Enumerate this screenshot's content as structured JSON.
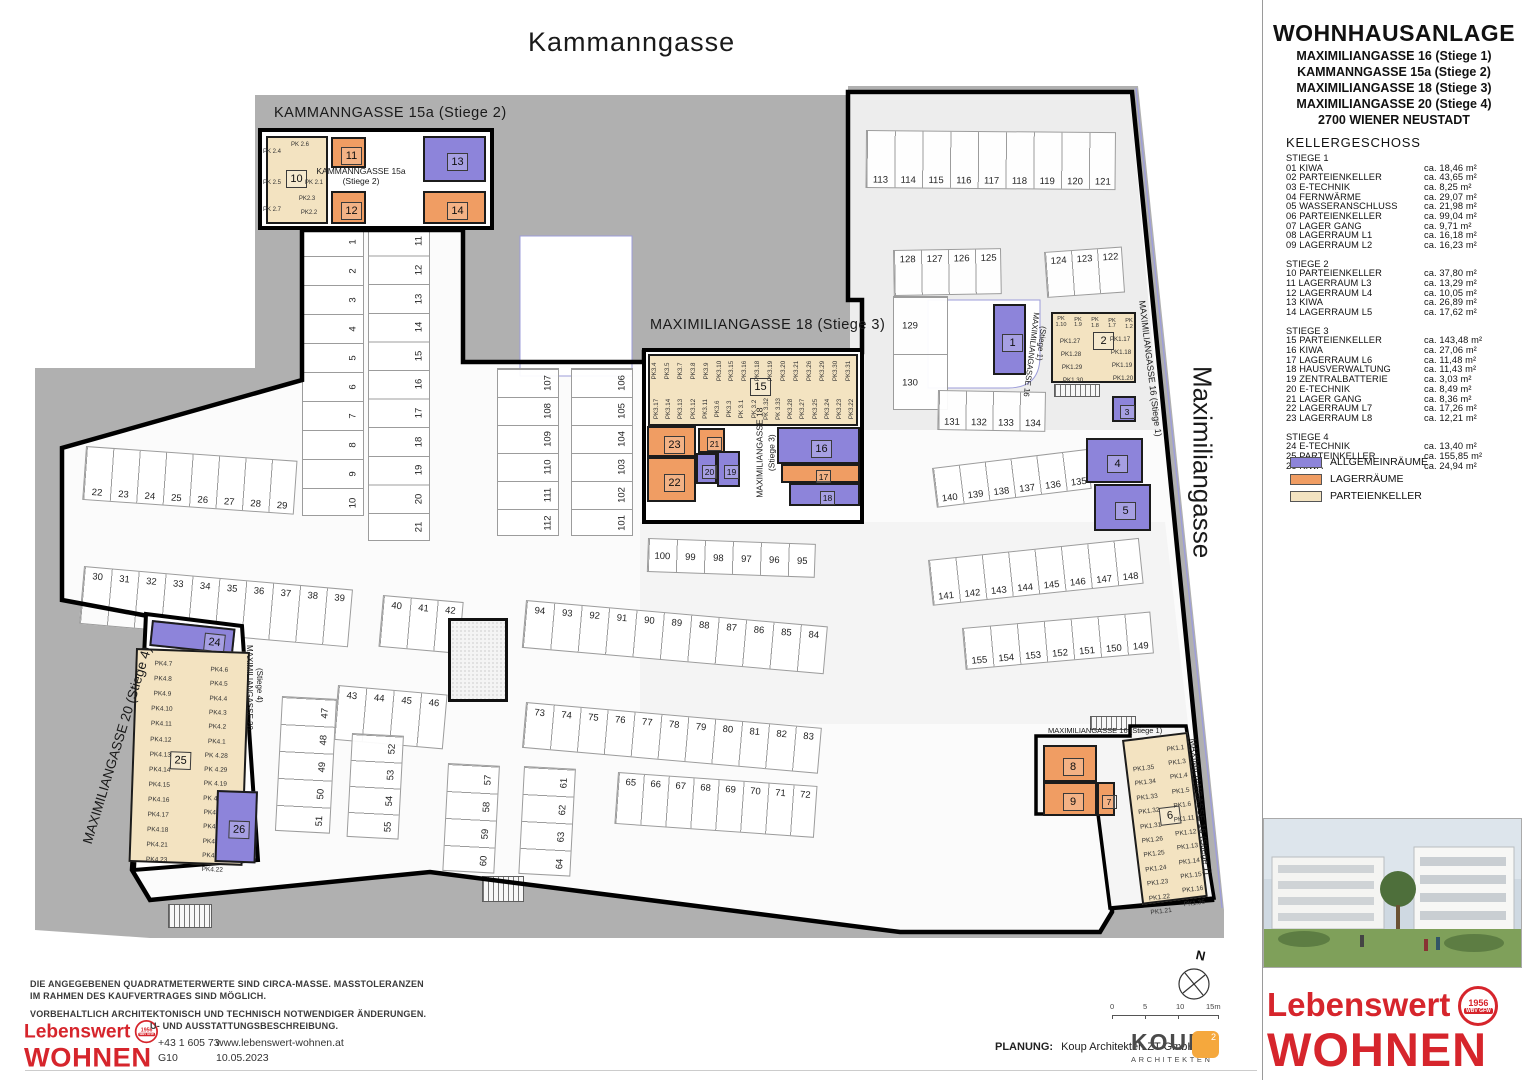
{
  "title_block": {
    "project": "WOHNHAUSANLAGE",
    "addresses": [
      "MAXIMILIANGASSE 16 (Stiege 1)",
      "KAMMANNGASSE 15a (Stiege 2)",
      "MAXIMILIANGASSE 18 (Stiege 3)",
      "MAXIMILIANGASSE 20 (Stiege 4)"
    ],
    "city": "2700 WIENER NEUSTADT",
    "floor": "KELLERGESCHOSS"
  },
  "schedule": [
    {
      "name": "STIEGE 1",
      "rooms": [
        {
          "nr": "01",
          "label": "KIWA",
          "area": "ca. 18,46 m²"
        },
        {
          "nr": "02",
          "label": "PARTEIENKELLER",
          "area": "ca. 43,65 m²"
        },
        {
          "nr": "03",
          "label": "E-TECHNIK",
          "area": "ca. 8,25 m²"
        },
        {
          "nr": "04",
          "label": "FERNWÄRME",
          "area": "ca. 29,07 m²"
        },
        {
          "nr": "05",
          "label": "WASSERANSCHLUSS",
          "area": "ca. 21,98 m²"
        },
        {
          "nr": "06",
          "label": "PARTEIENKELLER",
          "area": "ca. 99,04 m²"
        },
        {
          "nr": "07",
          "label": "LAGER GANG",
          "area": "ca. 9,71 m²"
        },
        {
          "nr": "08",
          "label": "LAGERRAUM L1",
          "area": "ca. 16,18 m²"
        },
        {
          "nr": "09",
          "label": "LAGERRAUM L2",
          "area": "ca. 16,23 m²"
        }
      ]
    },
    {
      "name": "STIEGE 2",
      "rooms": [
        {
          "nr": "10",
          "label": "PARTEIENKELLER",
          "area": "ca. 37,80 m²"
        },
        {
          "nr": "11",
          "label": "LAGERRAUM L3",
          "area": "ca. 13,29 m²"
        },
        {
          "nr": "12",
          "label": "LAGERRAUM L4",
          "area": "ca. 10,05 m²"
        },
        {
          "nr": "13",
          "label": "KIWA",
          "area": "ca. 26,89 m²"
        },
        {
          "nr": "14",
          "label": "LAGERRAUM L5",
          "area": "ca. 17,62 m²"
        }
      ]
    },
    {
      "name": "STIEGE 3",
      "rooms": [
        {
          "nr": "15",
          "label": "PARTEIENKELLER",
          "area": "ca. 143,48 m²"
        },
        {
          "nr": "16",
          "label": "KIWA",
          "area": "ca. 27,06 m²"
        },
        {
          "nr": "17",
          "label": "LAGERRAUM L6",
          "area": "ca. 11,48 m²"
        },
        {
          "nr": "18",
          "label": "HAUSVERWALTUNG",
          "area": "ca. 11,43 m²"
        },
        {
          "nr": "19",
          "label": "ZENTRALBATTERIE",
          "area": "ca. 3,03 m²"
        },
        {
          "nr": "20",
          "label": "E-TECHNIK",
          "area": "ca. 8,49 m²"
        },
        {
          "nr": "21",
          "label": "LAGER GANG",
          "area": "ca. 8,36 m²"
        },
        {
          "nr": "22",
          "label": "LAGERRAUM L7",
          "area": "ca. 17,26 m²"
        },
        {
          "nr": "23",
          "label": "LAGERRAUM L8",
          "area": "ca. 12,21 m²"
        }
      ]
    },
    {
      "name": "STIEGE 4",
      "rooms": [
        {
          "nr": "24",
          "label": "E-TECHNIK",
          "area": "ca. 13,40 m²"
        },
        {
          "nr": "25",
          "label": "PARTEINKELLER",
          "area": "ca. 155,85 m²"
        },
        {
          "nr": "26",
          "label": "KIWA",
          "area": "ca. 24,94 m²"
        }
      ]
    }
  ],
  "legend": [
    {
      "type": "allgemein",
      "label": "ALLGEMEINRÄUME",
      "color": "#8d84da"
    },
    {
      "type": "lager",
      "label": "LAGERRÄUME",
      "color": "#f09d63"
    },
    {
      "type": "partei",
      "label": "PARTEIENKELLER",
      "color": "#f3e3c1"
    }
  ],
  "streets": {
    "top": "Kammanngasse",
    "right": "Maximiliangasse"
  },
  "plan_labels": {
    "stiege2_header": "KAMMANNGASSE 15a (Stiege 2)",
    "stiege3_header": "MAXIMILIANGASSE 18 (Stiege 3)",
    "stiege4_diagonal": "MAXIMILIANGASSE 20 (Stiege 4)",
    "stiege2_center_l1": "KAMMANNGASSE 15a",
    "stiege2_center_l2": "(Stiege 2)",
    "stiege3_center_l1": "MAXIMILIANGASSE 18",
    "stiege3_center_l2": "(Stiege 3)",
    "stiege4_small_l1": "MAXIMILIANGASSE 20",
    "stiege4_small_l2": "(Stiege 4)",
    "stiege1_small_l1": "MAXIMILIANGASSE 16",
    "stiege1_small_l2": "(Stiege 1)",
    "stiege1_street_top": "MAXIMILIANGASSE 16 (Stiege 1)",
    "stiege1_horizontal": "MAXIMILIANGASSE 16 (Stiege 1)",
    "stiege1_street_bottom": "MAXIMILIANGASSE 16 (Stiege 1)"
  },
  "rooms": [
    {
      "nr": "1",
      "type": "allgemein"
    },
    {
      "nr": "2",
      "type": "partei"
    },
    {
      "nr": "3",
      "type": "allgemein"
    },
    {
      "nr": "4",
      "type": "allgemein"
    },
    {
      "nr": "5",
      "type": "allgemein"
    },
    {
      "nr": "6",
      "type": "partei"
    },
    {
      "nr": "7",
      "type": "lager"
    },
    {
      "nr": "8",
      "type": "lager"
    },
    {
      "nr": "9",
      "type": "lager"
    },
    {
      "nr": "10",
      "type": "partei"
    },
    {
      "nr": "11",
      "type": "lager"
    },
    {
      "nr": "12",
      "type": "lager"
    },
    {
      "nr": "13",
      "type": "allgemein"
    },
    {
      "nr": "14",
      "type": "lager"
    },
    {
      "nr": "15",
      "type": "partei"
    },
    {
      "nr": "16",
      "type": "allgemein"
    },
    {
      "nr": "17",
      "type": "lager"
    },
    {
      "nr": "18",
      "type": "allgemein"
    },
    {
      "nr": "19",
      "type": "allgemein"
    },
    {
      "nr": "20",
      "type": "allgemein"
    },
    {
      "nr": "21",
      "type": "lager"
    },
    {
      "nr": "22",
      "type": "lager"
    },
    {
      "nr": "23",
      "type": "lager"
    },
    {
      "nr": "24",
      "type": "allgemein"
    },
    {
      "nr": "25",
      "type": "partei"
    },
    {
      "nr": "26",
      "type": "allgemein"
    }
  ],
  "pk_labels": {
    "stiege2": [
      "PK 2.4",
      "PK 2.6",
      "PK 2.1",
      "PK 2.5",
      "PK2.3",
      "PK2.2",
      "PK 2.7"
    ],
    "stiege3_top": [
      "PK3.4",
      "PK3.5",
      "PK3.7",
      "PK3.8",
      "PK3.9",
      "PK3.10",
      "PK3.15",
      "PK3.16",
      "PK3.18",
      "PK3.19",
      "PK3.20",
      "PK3.21",
      "PK3.26",
      "PK3.29",
      "PK3.30",
      "PK3.31"
    ],
    "stiege3_bottom": [
      "PK3.17",
      "PK3.14",
      "PK3.13",
      "PK3.12",
      "PK3.11",
      "PK3.6",
      "PK3.3",
      "PK 3.1",
      "PK 3.2",
      "PK 3.32",
      "PK 3.33",
      "PK3.28",
      "PK3.27",
      "PK3.25",
      "PK3.24",
      "PK3.23",
      "PK3.22"
    ],
    "stiege1_top_row": [
      "PK 1.10",
      "PK 1.9",
      "PK 1.8",
      "PK 1.7",
      "PK 1.2"
    ],
    "stiege1_top_left": [
      "PK1.27",
      "PK1.28",
      "PK1.29",
      "PK1.30"
    ],
    "stiege1_top_right": [
      "PK1.17",
      "PK1.18",
      "PK1.19",
      "PK1.20"
    ],
    "stiege4_left": [
      "PK4.7",
      "PK4.8",
      "PK4.9",
      "PK4.10",
      "PK4.11",
      "PK4.12",
      "PK4.13",
      "PK4.14",
      "PK4.15",
      "PK4.16",
      "PK4.17",
      "PK4.18",
      "PK4.21",
      "PK4.23"
    ],
    "stiege4_right": [
      "PK4.6",
      "PK4.5",
      "PK4.4",
      "PK4.3",
      "PK4.2",
      "PK4.1",
      "PK 4.28",
      "PK 4.29",
      "PK 4.19",
      "PK 4.20",
      "PK4.27",
      "PK4.26",
      "PK4.25",
      "PK4.24",
      "PK4.22"
    ],
    "stiege1_bottom_left": [
      "PK1.35",
      "PK1.34",
      "PK1.33",
      "PK1.32",
      "PK1.31",
      "PK1.26",
      "PK1.25",
      "PK1.24",
      "PK1.23",
      "PK1.22",
      "PK1.21"
    ],
    "stiege1_bottom_right": [
      "PK1.1",
      "PK1.3",
      "PK1.4",
      "PK1.5",
      "PK1.6",
      "PK1.11",
      "PK1.12",
      "PK1.13",
      "PK1.14",
      "PK1.15",
      "PK1.16",
      "PK1.36"
    ]
  },
  "parking": [
    {
      "id": "col-1-10",
      "numbers": [
        "1",
        "2",
        "3",
        "4",
        "5",
        "6",
        "7",
        "8",
        "9",
        "10"
      ]
    },
    {
      "id": "col-11-21",
      "numbers": [
        "11",
        "12",
        "13",
        "14",
        "15",
        "16",
        "17",
        "18",
        "19",
        "20",
        "21"
      ]
    },
    {
      "id": "col-107-112",
      "numbers": [
        "107",
        "108",
        "109",
        "110",
        "111",
        "112"
      ]
    },
    {
      "id": "col-106-101",
      "numbers": [
        "106",
        "105",
        "104",
        "103",
        "102",
        "101"
      ]
    },
    {
      "id": "row-113-121",
      "numbers": [
        "113",
        "114",
        "115",
        "116",
        "117",
        "118",
        "119",
        "120",
        "121"
      ]
    },
    {
      "id": "row-125-128",
      "numbers": [
        "128",
        "127",
        "126",
        "125"
      ]
    },
    {
      "id": "row-122-124",
      "numbers": [
        "124",
        "123",
        "122"
      ]
    },
    {
      "id": "col-129-130",
      "numbers": [
        "129",
        "130"
      ]
    },
    {
      "id": "row-131-134",
      "numbers": [
        "131",
        "132",
        "133",
        "134"
      ]
    },
    {
      "id": "row-135-140",
      "numbers": [
        "140",
        "139",
        "138",
        "137",
        "136",
        "135"
      ]
    },
    {
      "id": "row-141-148",
      "numbers": [
        "141",
        "142",
        "143",
        "144",
        "145",
        "146",
        "147",
        "148"
      ]
    },
    {
      "id": "row-149-155",
      "numbers": [
        "155",
        "154",
        "153",
        "152",
        "151",
        "150",
        "149"
      ]
    },
    {
      "id": "row-22-29",
      "numbers": [
        "22",
        "23",
        "24",
        "25",
        "26",
        "27",
        "28",
        "29"
      ]
    },
    {
      "id": "row-30-39",
      "numbers": [
        "30",
        "31",
        "32",
        "33",
        "34",
        "35",
        "36",
        "37",
        "38",
        "39"
      ]
    },
    {
      "id": "row-40-42",
      "numbers": [
        "40",
        "41",
        "42"
      ]
    },
    {
      "id": "row-43-46",
      "numbers": [
        "43",
        "44",
        "45",
        "46"
      ]
    },
    {
      "id": "col-47-51",
      "numbers": [
        "47",
        "48",
        "49",
        "50",
        "51"
      ]
    },
    {
      "id": "col-52-55",
      "numbers": [
        "52",
        "53",
        "54",
        "55"
      ]
    },
    {
      "id": "col-57-60",
      "numbers": [
        "57",
        "58",
        "59",
        "60"
      ]
    },
    {
      "id": "col-61-64",
      "numbers": [
        "61",
        "62",
        "63",
        "64"
      ]
    },
    {
      "id": "row-65-72",
      "numbers": [
        "65",
        "66",
        "67",
        "68",
        "69",
        "70",
        "71",
        "72"
      ]
    },
    {
      "id": "row-73-83",
      "numbers": [
        "73",
        "74",
        "75",
        "76",
        "77",
        "78",
        "79",
        "80",
        "81",
        "82",
        "83"
      ]
    },
    {
      "id": "row-84-94",
      "numbers": [
        "94",
        "93",
        "92",
        "91",
        "90",
        "89",
        "88",
        "87",
        "86",
        "85",
        "84"
      ]
    },
    {
      "id": "row-95-100",
      "numbers": [
        "100",
        "99",
        "98",
        "97",
        "96",
        "95"
      ]
    }
  ],
  "north": "N",
  "scale": {
    "ticks": [
      "0",
      "5",
      "10",
      "15m"
    ]
  },
  "footer": {
    "note1a": "DIE ANGEGEBENEN QUADRATMETERWERTE SIND CIRCA-MASSE. MASSTOLERANZEN",
    "note1b": "IM RAHMEN DES KAUFVERTRAGES SIND MÖGLICH.",
    "note2": "VORBEHALTLICH ARCHITEKTONISCH UND TECHNISCH NOTWENDIGER ÄNDERUNGEN.",
    "note3": "U- UND AUSSTATTUNGSBESCHREIBUNG.",
    "phone": "+43 1 605 73",
    "plan_nr": "G10",
    "web": "www.lebenswert-wohnen.at",
    "date": "10.05.2023",
    "planung_label": "PLANUNG:",
    "planung_value": "Koup Architekten ZT GmbH"
  },
  "logos": {
    "lebenswert_line1": "Lebenswert",
    "lebenswert_line2": "WOHNEN",
    "seal_year": "1956",
    "seal_text": "WBV GFW",
    "koup": "KOUP",
    "koup_sub": "ARCHITEKTEN",
    "koup_badge": "2",
    "red": "#d6252c",
    "orange": "#f5a83d"
  }
}
